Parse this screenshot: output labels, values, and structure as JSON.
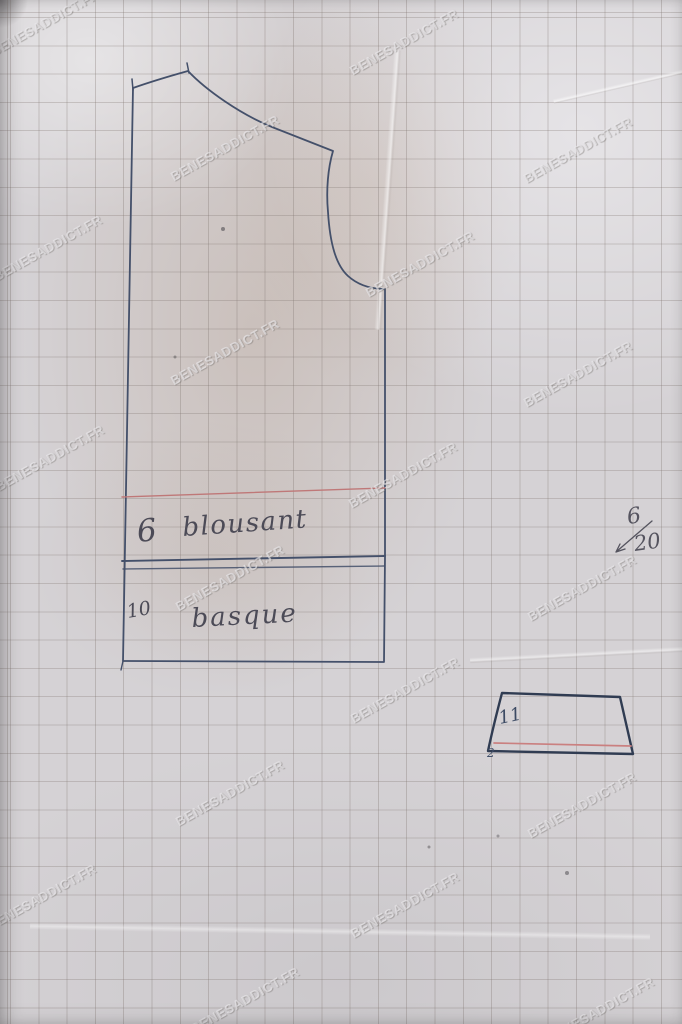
{
  "page": {
    "width": 682,
    "height": 1024,
    "paper_color": "#d5d2d5",
    "grid_color": "rgba(128,117,112,0.33)"
  },
  "watermark": {
    "text": "BENESADDICT.FR",
    "color": "rgba(241,239,242,0.62)",
    "positions": [
      {
        "x": 45,
        "y": 23
      },
      {
        "x": 404,
        "y": 42
      },
      {
        "x": 578,
        "y": 150
      },
      {
        "x": 225,
        "y": 148
      },
      {
        "x": 48,
        "y": 248
      },
      {
        "x": 420,
        "y": 264
      },
      {
        "x": 225,
        "y": 352
      },
      {
        "x": 578,
        "y": 374
      },
      {
        "x": 50,
        "y": 458
      },
      {
        "x": 403,
        "y": 475
      },
      {
        "x": 230,
        "y": 578
      },
      {
        "x": 582,
        "y": 588
      },
      {
        "x": 405,
        "y": 690
      },
      {
        "x": 230,
        "y": 793
      },
      {
        "x": 582,
        "y": 805
      },
      {
        "x": 42,
        "y": 897
      },
      {
        "x": 405,
        "y": 905
      },
      {
        "x": 245,
        "y": 1000
      },
      {
        "x": 600,
        "y": 1010
      }
    ]
  },
  "drawing": {
    "ink_color": "#44506a",
    "ink_color_dark": "#303c52",
    "accent_red": "#bf7878",
    "pencil_color": "#4c4b57",
    "labels": {
      "ease_value": "6",
      "ease_label": "blousant",
      "basque_value": "10",
      "basque_label": "basque",
      "size_numerator": "6",
      "size_denominator": "20",
      "piece_number": "11",
      "piece_mark": "2"
    }
  }
}
